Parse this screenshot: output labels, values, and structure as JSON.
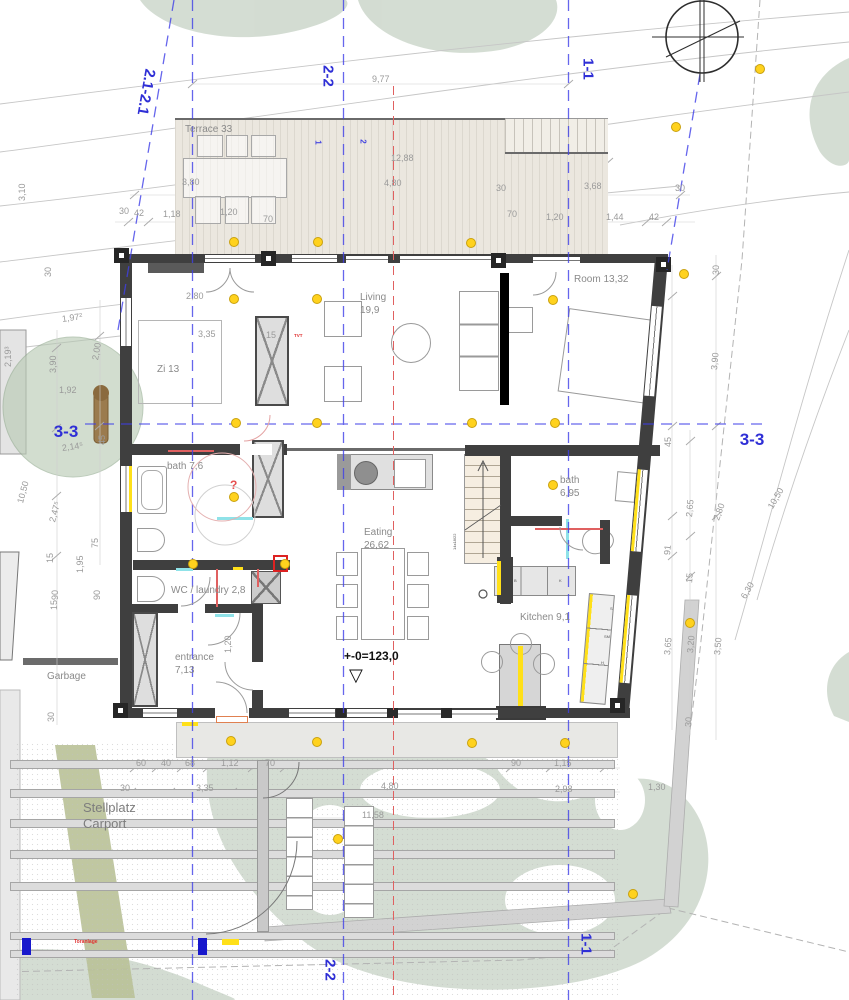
{
  "drawing": {
    "kind": "ground floor plan with terrace, carport and site"
  },
  "sections": [
    {
      "id": "section-2.1-2.1",
      "t": "2.1-2.1",
      "x": 146,
      "y": 92,
      "r": 100,
      "s": 15
    },
    {
      "id": "section-2-2-top",
      "t": "2-2",
      "x": 328,
      "y": 76,
      "r": 90,
      "s": 15
    },
    {
      "id": "section-1-1-top",
      "t": "1-1",
      "x": 588,
      "y": 69,
      "r": 90,
      "s": 15
    },
    {
      "id": "section-3-3-left",
      "t": "3-3",
      "x": 66,
      "y": 432,
      "r": 0,
      "s": 17
    },
    {
      "id": "section-3-3-right",
      "t": "3-3",
      "x": 752,
      "y": 440,
      "r": 0,
      "s": 17
    },
    {
      "id": "section-2-2-bottom",
      "t": "2-2",
      "x": 330,
      "y": 970,
      "r": 90,
      "s": 15
    },
    {
      "id": "section-1-1-bottom",
      "t": "1-1",
      "x": 586,
      "y": 944,
      "r": 90,
      "s": 15
    }
  ],
  "axis_numbers": [
    {
      "t": "1",
      "x": 316,
      "y": 138
    },
    {
      "t": "2",
      "x": 361,
      "y": 137
    }
  ],
  "rooms": [
    {
      "id": "terrace",
      "label": "Terrace 33",
      "x": 185,
      "y": 124
    },
    {
      "id": "zi13",
      "label": "Zi 13",
      "x": 157,
      "y": 364
    },
    {
      "id": "living",
      "label": "Living\n19,9",
      "x": 360,
      "y": 292
    },
    {
      "id": "room",
      "label": "Room 13,32",
      "x": 574,
      "y": 274
    },
    {
      "id": "bath-1",
      "label": "bath 7,6",
      "x": 167,
      "y": 461
    },
    {
      "id": "bath-2",
      "label": "bath\n6,95",
      "x": 560,
      "y": 475
    },
    {
      "id": "eating",
      "label": "Eating\n26,62",
      "x": 364,
      "y": 527
    },
    {
      "id": "wc-laundry",
      "label": "WC / laundry 2,8",
      "x": 171,
      "y": 585
    },
    {
      "id": "entrance",
      "label": "entrance\n7,13",
      "x": 175,
      "y": 652
    },
    {
      "id": "kitchen",
      "label": "Kitchen 9,1",
      "x": 520,
      "y": 612
    },
    {
      "id": "garbage",
      "label": "Garbage",
      "x": 47,
      "y": 671
    },
    {
      "id": "carport",
      "label": "Stellplatz\nCarport",
      "x": 83,
      "y": 800,
      "s": 13
    }
  ],
  "annotations": [
    {
      "id": "level-marker",
      "t": "+-0=123,0",
      "x": 344,
      "y": 650,
      "c": "#111111",
      "s": 12,
      "w": "bold"
    },
    {
      "id": "level-triangle",
      "t": "▽",
      "x": 349,
      "y": 666,
      "c": "#111111",
      "s": 18,
      "w": "normal"
    },
    {
      "id": "gate-label",
      "t": "Toranlage",
      "x": 74,
      "y": 940,
      "c": "#e03030",
      "s": 5,
      "w": "bold"
    },
    {
      "id": "tvt-note",
      "t": "TVT",
      "x": 294,
      "y": 334,
      "c": "#e03030",
      "s": 4.5,
      "w": "bold"
    },
    {
      "id": "question-note",
      "t": "?",
      "x": 230,
      "y": 479,
      "c": "#e65050",
      "s": 12,
      "w": "bold"
    },
    {
      "id": "stair-note",
      "t": "14x18/22",
      "x": 455,
      "y": 548,
      "c": "#555555",
      "s": 4,
      "w": "normal",
      "r": -90
    }
  ],
  "cabinet_labels": [
    {
      "t": "B",
      "x": 514,
      "y": 578
    },
    {
      "t": "K",
      "x": 559,
      "y": 578
    },
    {
      "t": "S",
      "x": 610,
      "y": 606
    },
    {
      "t": "SM",
      "x": 604,
      "y": 634
    },
    {
      "t": "H",
      "x": 601,
      "y": 660
    }
  ],
  "dimensions": [
    {
      "t": "9,77",
      "x": 372,
      "y": 74
    },
    {
      "t": "12,88",
      "x": 391,
      "y": 153
    },
    {
      "t": "3,80",
      "x": 182,
      "y": 177
    },
    {
      "t": "4,80",
      "x": 384,
      "y": 178
    },
    {
      "t": "3,68",
      "x": 584,
      "y": 181
    },
    {
      "t": "30",
      "x": 496,
      "y": 183
    },
    {
      "t": "30",
      "x": 675,
      "y": 183
    },
    {
      "t": "30",
      "x": 119,
      "y": 206
    },
    {
      "t": "42",
      "x": 134,
      "y": 208
    },
    {
      "t": "1,18",
      "x": 163,
      "y": 209
    },
    {
      "t": "1,20",
      "x": 220,
      "y": 207
    },
    {
      "t": "70",
      "x": 263,
      "y": 214
    },
    {
      "t": "70",
      "x": 507,
      "y": 209
    },
    {
      "t": "1,20",
      "x": 546,
      "y": 212
    },
    {
      "t": "1,44",
      "x": 606,
      "y": 212
    },
    {
      "t": "42",
      "x": 649,
      "y": 212
    },
    {
      "t": "3,10",
      "x": 22,
      "y": 196,
      "r": -90
    },
    {
      "t": "30",
      "x": 48,
      "y": 272,
      "r": -90
    },
    {
      "t": "1,97²",
      "x": 62,
      "y": 314,
      "r": -8
    },
    {
      "t": "2,19³",
      "x": 8,
      "y": 362,
      "r": -90
    },
    {
      "t": "3,90",
      "x": 53,
      "y": 368,
      "r": -90
    },
    {
      "t": "2,00",
      "x": 95,
      "y": 355,
      "r": -80
    },
    {
      "t": "1,92",
      "x": 59,
      "y": 385
    },
    {
      "t": "45",
      "x": 102,
      "y": 440,
      "r": -90
    },
    {
      "t": "2,14⁵",
      "x": 62,
      "y": 443,
      "r": -8
    },
    {
      "t": "10,50",
      "x": 20,
      "y": 498,
      "r": -75
    },
    {
      "t": "2,47⁵",
      "x": 52,
      "y": 517,
      "r": -75
    },
    {
      "t": "75",
      "x": 95,
      "y": 543,
      "r": -90
    },
    {
      "t": "15",
      "x": 50,
      "y": 558,
      "r": -90
    },
    {
      "t": "1,95",
      "x": 80,
      "y": 568,
      "r": -90
    },
    {
      "t": "90",
      "x": 55,
      "y": 595,
      "r": -90
    },
    {
      "t": "90",
      "x": 97,
      "y": 595,
      "r": -90
    },
    {
      "t": "15",
      "x": 54,
      "y": 605,
      "r": -90
    },
    {
      "t": "30",
      "x": 51,
      "y": 717,
      "r": -90
    },
    {
      "t": "2,80",
      "x": 186,
      "y": 291
    },
    {
      "t": "3,35",
      "x": 198,
      "y": 329
    },
    {
      "t": "15",
      "x": 266,
      "y": 330
    },
    {
      "t": "1,20",
      "x": 228,
      "y": 648,
      "r": -90
    },
    {
      "t": "30",
      "x": 716,
      "y": 270,
      "r": -90
    },
    {
      "t": "3,90",
      "x": 714,
      "y": 365,
      "r": -85
    },
    {
      "t": "45",
      "x": 668,
      "y": 442,
      "r": -90
    },
    {
      "t": "2,65",
      "x": 689,
      "y": 512,
      "r": -85
    },
    {
      "t": "2,80",
      "x": 716,
      "y": 515,
      "r": -70
    },
    {
      "t": "91",
      "x": 667,
      "y": 550,
      "r": -85
    },
    {
      "t": "15",
      "x": 689,
      "y": 578,
      "r": -85
    },
    {
      "t": "10,50",
      "x": 770,
      "y": 503,
      "r": -60
    },
    {
      "t": "6,30",
      "x": 743,
      "y": 593,
      "r": -60
    },
    {
      "t": "3,65",
      "x": 667,
      "y": 650,
      "r": -85
    },
    {
      "t": "3,20",
      "x": 690,
      "y": 648,
      "r": -85
    },
    {
      "t": "3,50",
      "x": 717,
      "y": 650,
      "r": -85
    },
    {
      "t": "30",
      "x": 688,
      "y": 722,
      "r": -85
    },
    {
      "t": "60",
      "x": 136,
      "y": 758
    },
    {
      "t": "40",
      "x": 161,
      "y": 758
    },
    {
      "t": "68",
      "x": 185,
      "y": 758
    },
    {
      "t": "1,12",
      "x": 221,
      "y": 758
    },
    {
      "t": "70",
      "x": 265,
      "y": 758
    },
    {
      "t": "90",
      "x": 511,
      "y": 758
    },
    {
      "t": "1,15",
      "x": 554,
      "y": 758
    },
    {
      "t": "30",
      "x": 120,
      "y": 783
    },
    {
      "t": "3,35",
      "x": 196,
      "y": 783
    },
    {
      "t": "4,80",
      "x": 381,
      "y": 781
    },
    {
      "t": "2,98",
      "x": 555,
      "y": 784
    },
    {
      "t": "11,58",
      "x": 362,
      "y": 810
    },
    {
      "t": "1,30",
      "x": 648,
      "y": 782
    }
  ],
  "dots": [
    [
      233,
      241
    ],
    [
      317,
      241
    ],
    [
      470,
      242
    ],
    [
      675,
      126
    ],
    [
      759,
      68
    ],
    [
      683,
      273
    ],
    [
      233,
      298
    ],
    [
      316,
      298
    ],
    [
      552,
      299
    ],
    [
      235,
      422
    ],
    [
      316,
      422
    ],
    [
      471,
      422
    ],
    [
      554,
      422
    ],
    [
      233,
      496
    ],
    [
      552,
      484
    ],
    [
      192,
      563
    ],
    [
      284,
      563
    ],
    [
      689,
      622
    ],
    [
      230,
      740
    ],
    [
      316,
      741
    ],
    [
      471,
      742
    ],
    [
      564,
      742
    ],
    [
      337,
      838
    ],
    [
      632,
      893
    ]
  ]
}
